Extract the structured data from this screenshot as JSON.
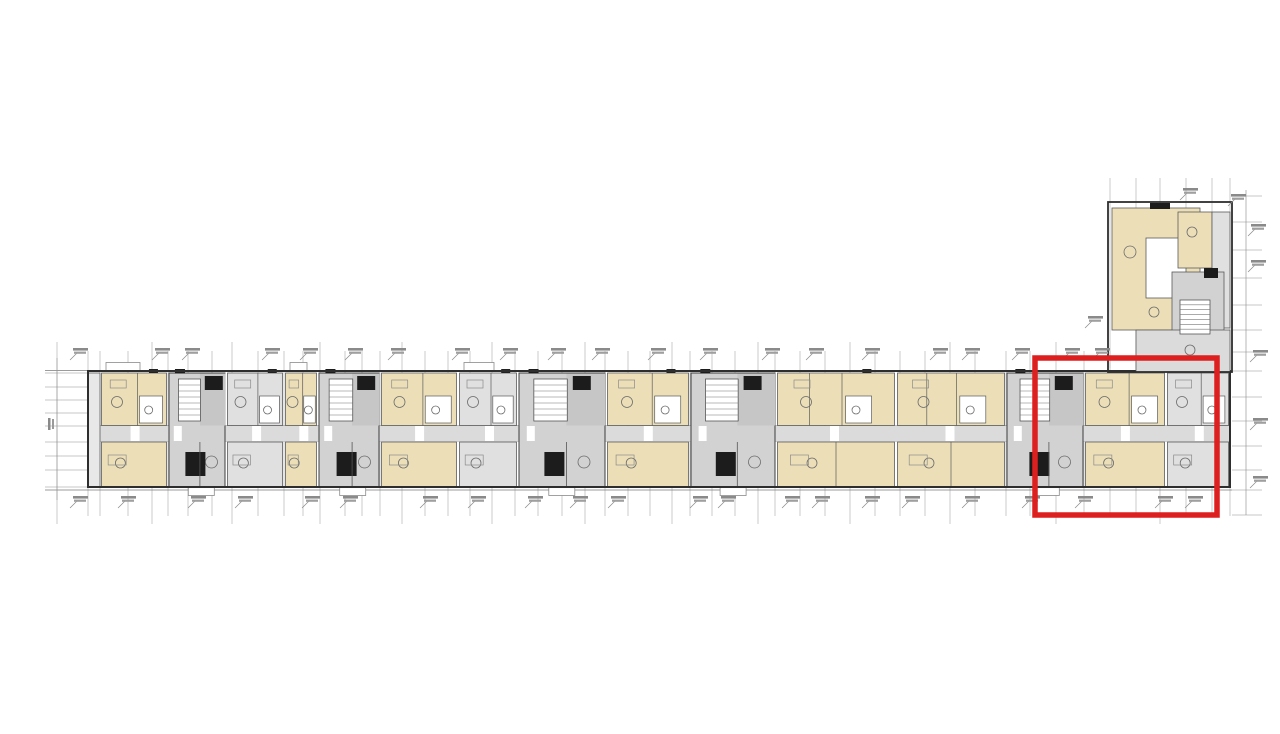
{
  "document": {
    "kind": "architectural-floor-plan",
    "description": "Long multi-unit residential building floor plan with perpendicular wing at upper right; one end unit outlined with a red selection rectangle. All dimension/elevation texts are micro-scale tick annotations (illegible at native resolution), represented as mark positions.",
    "background": "#ffffff"
  },
  "palette": {
    "beige": "#ecdfb8",
    "beige_light": "#f2e7c8",
    "gray_fill": "#d2d2d2",
    "gray_soft": "#dbdbdb",
    "gray_room": "#e0e0e0",
    "gray_band": "#c6c6c6",
    "wall_dark": "#2e2e2e",
    "wall_mid": "#5a5a5a",
    "line_thin": "#8a8a8a",
    "grid_line": "#b5b5b5",
    "shaft_black": "#1c1c1c",
    "white": "#ffffff",
    "highlight_red": "#dd1f1f"
  },
  "canvas": {
    "w": 1280,
    "h": 734
  },
  "strip": {
    "x": 88,
    "y": 371,
    "w": 1142,
    "h": 116,
    "corridor_y": 426,
    "corridor_h": 15.5,
    "corridor_top": 425.5,
    "corridor_bottom": 441.5
  },
  "modules": [
    {
      "x": 100,
      "w": 68,
      "kind": "unit"
    },
    {
      "x": 168,
      "w": 58,
      "kind": "core"
    },
    {
      "x": 226,
      "w": 58,
      "kind": "gray"
    },
    {
      "x": 284,
      "w": 34,
      "kind": "unit"
    },
    {
      "x": 318,
      "w": 62,
      "kind": "core"
    },
    {
      "x": 380,
      "w": 78,
      "kind": "unit"
    },
    {
      "x": 458,
      "w": 60,
      "kind": "gray"
    },
    {
      "x": 518,
      "w": 88,
      "kind": "core"
    },
    {
      "x": 606,
      "w": 84,
      "kind": "unit"
    },
    {
      "x": 690,
      "w": 86,
      "kind": "core"
    },
    {
      "x": 776,
      "w": 120,
      "kind": "unit"
    },
    {
      "x": 896,
      "w": 110,
      "kind": "unit"
    },
    {
      "x": 1006,
      "w": 78,
      "kind": "core"
    },
    {
      "x": 1084,
      "w": 82,
      "kind": "unit"
    },
    {
      "x": 1166,
      "w": 64,
      "kind": "gray"
    }
  ],
  "grid": {
    "verticals": [
      57,
      88,
      100,
      128,
      152,
      168,
      188,
      212,
      232,
      258,
      284,
      303,
      320,
      345,
      362,
      380,
      402,
      425,
      448,
      470,
      492,
      515,
      538,
      562,
      585,
      605,
      628,
      650,
      672,
      690,
      712,
      735,
      758,
      775,
      800,
      825,
      850,
      875,
      900,
      925,
      950,
      975,
      1006,
      1030,
      1056,
      1084,
      1110,
      1136,
      1160,
      1186,
      1212,
      1230
    ],
    "y_top": 351,
    "y_bottom": 516,
    "y_top_major": 342,
    "y_bottom_major": 524
  },
  "long_lines": [
    {
      "y": 370.5,
      "x1": 45,
      "x2": 1232,
      "w": 0.8
    },
    {
      "y": 490,
      "x1": 45,
      "x2": 1232,
      "w": 0.8
    },
    {
      "y": 425.5,
      "x1": 88,
      "x2": 1230,
      "w": 0.6
    },
    {
      "y": 441.5,
      "x1": 88,
      "x2": 1230,
      "w": 0.6
    }
  ],
  "left_chain": {
    "vx": 57,
    "y1": 358,
    "y2": 500,
    "tick_x1": 45,
    "tick_x2": 88,
    "ticks": [
      373,
      387,
      400,
      413,
      426,
      442,
      456,
      470,
      487
    ]
  },
  "right_chain": {
    "vx": 1246,
    "y1": 190,
    "y2": 515,
    "tick_x1": 1232,
    "tick_x2": 1262,
    "ticks": [
      196,
      222,
      250,
      278,
      305,
      330,
      352,
      371,
      397,
      421,
      446,
      470,
      490,
      515
    ]
  },
  "wing": {
    "outline": {
      "x": 1108,
      "y": 202,
      "w": 124,
      "h": 170
    },
    "verticals": [
      1110,
      1136,
      1160,
      1186,
      1212,
      1230
    ],
    "verticals_y1": 178,
    "verticals_y2": 368,
    "rects": [
      {
        "x": 1112,
        "y": 208,
        "w": 88,
        "h": 122,
        "fill": "beige",
        "name": "wing-room-large"
      },
      {
        "x": 1146,
        "y": 238,
        "w": 40,
        "h": 60,
        "fill": "white",
        "name": "wing-bath-pod"
      },
      {
        "x": 1178,
        "y": 212,
        "w": 34,
        "h": 56,
        "fill": "beige",
        "name": "wing-room-upper-right"
      },
      {
        "x": 1212,
        "y": 212,
        "w": 18,
        "h": 116,
        "fill": "gray_room",
        "name": "wing-right-band"
      },
      {
        "x": 1172,
        "y": 272,
        "w": 52,
        "h": 96,
        "fill": "gray_fill",
        "name": "wing-core"
      },
      {
        "x": 1136,
        "y": 330,
        "w": 94,
        "h": 42,
        "fill": "gray_soft",
        "name": "wing-corridor"
      }
    ],
    "stair": {
      "x": 1180,
      "y": 300,
      "w": 30,
      "h": 34,
      "rungs": 6
    },
    "shafts": [
      {
        "x": 1150,
        "y": 203,
        "w": 20,
        "h": 6
      },
      {
        "x": 1204,
        "y": 268,
        "w": 14,
        "h": 10
      }
    ],
    "circles": [
      {
        "cx": 1130,
        "cy": 252,
        "r": 6
      },
      {
        "cx": 1192,
        "cy": 232,
        "r": 5
      },
      {
        "cx": 1154,
        "cy": 312,
        "r": 5
      },
      {
        "cx": 1190,
        "cy": 350,
        "r": 5
      }
    ]
  },
  "annotations": {
    "top": [
      70,
      152,
      182,
      262,
      300,
      345,
      388,
      452,
      500,
      548,
      592,
      648,
      700,
      762,
      806,
      862,
      930,
      962,
      1012,
      1062,
      1092
    ],
    "top_y": 350,
    "bottom": [
      70,
      118,
      188,
      235,
      302,
      340,
      420,
      468,
      525,
      570,
      608,
      690,
      718,
      782,
      812,
      862,
      902,
      962,
      1022,
      1075,
      1155,
      1185
    ],
    "bottom_y": 498,
    "floating": [
      {
        "x": 1085,
        "y": 318
      },
      {
        "x": 1180,
        "y": 190
      },
      {
        "x": 1228,
        "y": 196
      },
      {
        "x": 1248,
        "y": 226
      },
      {
        "x": 1248,
        "y": 262
      },
      {
        "x": 1250,
        "y": 352
      },
      {
        "x": 1250,
        "y": 420
      },
      {
        "x": 1250,
        "y": 478
      }
    ]
  },
  "highlight": {
    "x": 1035,
    "y": 358,
    "w": 182,
    "h": 157,
    "stroke_width": 5.5,
    "color": "#dd1f1f",
    "label": "selected-unit-region"
  }
}
